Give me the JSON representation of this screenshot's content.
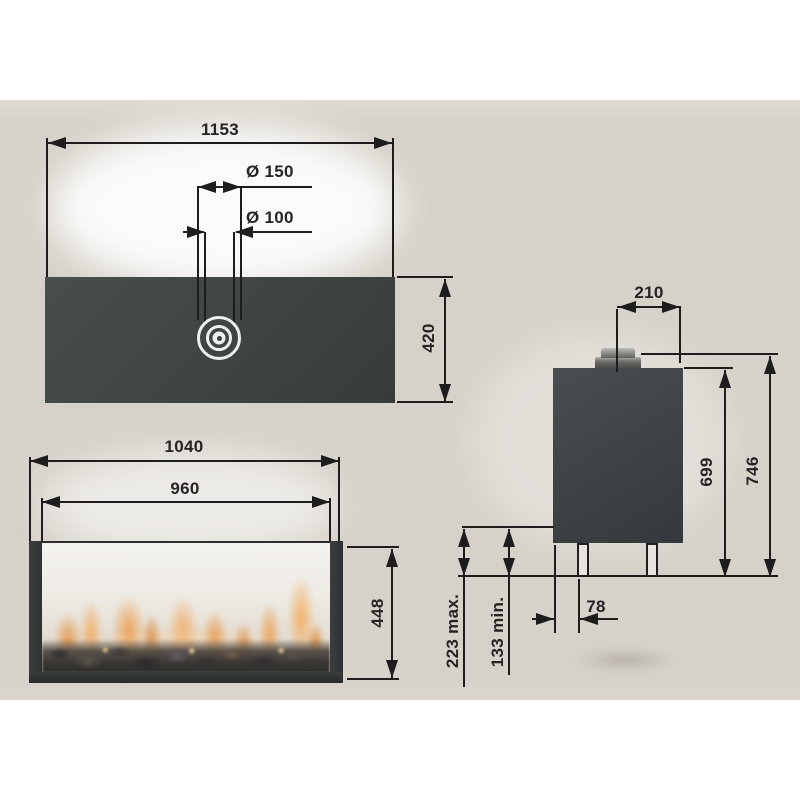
{
  "drawing": {
    "kind": "fireplace dimension drawing",
    "views": {
      "top": {
        "overall_width": "1153",
        "flue_outer_diameter": "Ø 150",
        "flue_inner_diameter": "Ø 100",
        "depth": "420"
      },
      "front": {
        "overall_width": "1040",
        "opening_width": "960",
        "height": "448"
      },
      "side": {
        "flue_center_offset": "210",
        "body_height": "699",
        "overall_height": "746",
        "leg_inset": "78",
        "clearance_max": "223 max.",
        "clearance_min": "133 min."
      }
    },
    "colors": {
      "page_white": "#ffffff",
      "paper_beige": "#d6d1c9",
      "unit_dark": "#3e4442",
      "line": "#1d1d1d",
      "flame_orange": "#eda159",
      "flue_ring_white": "#eef0ee"
    }
  }
}
